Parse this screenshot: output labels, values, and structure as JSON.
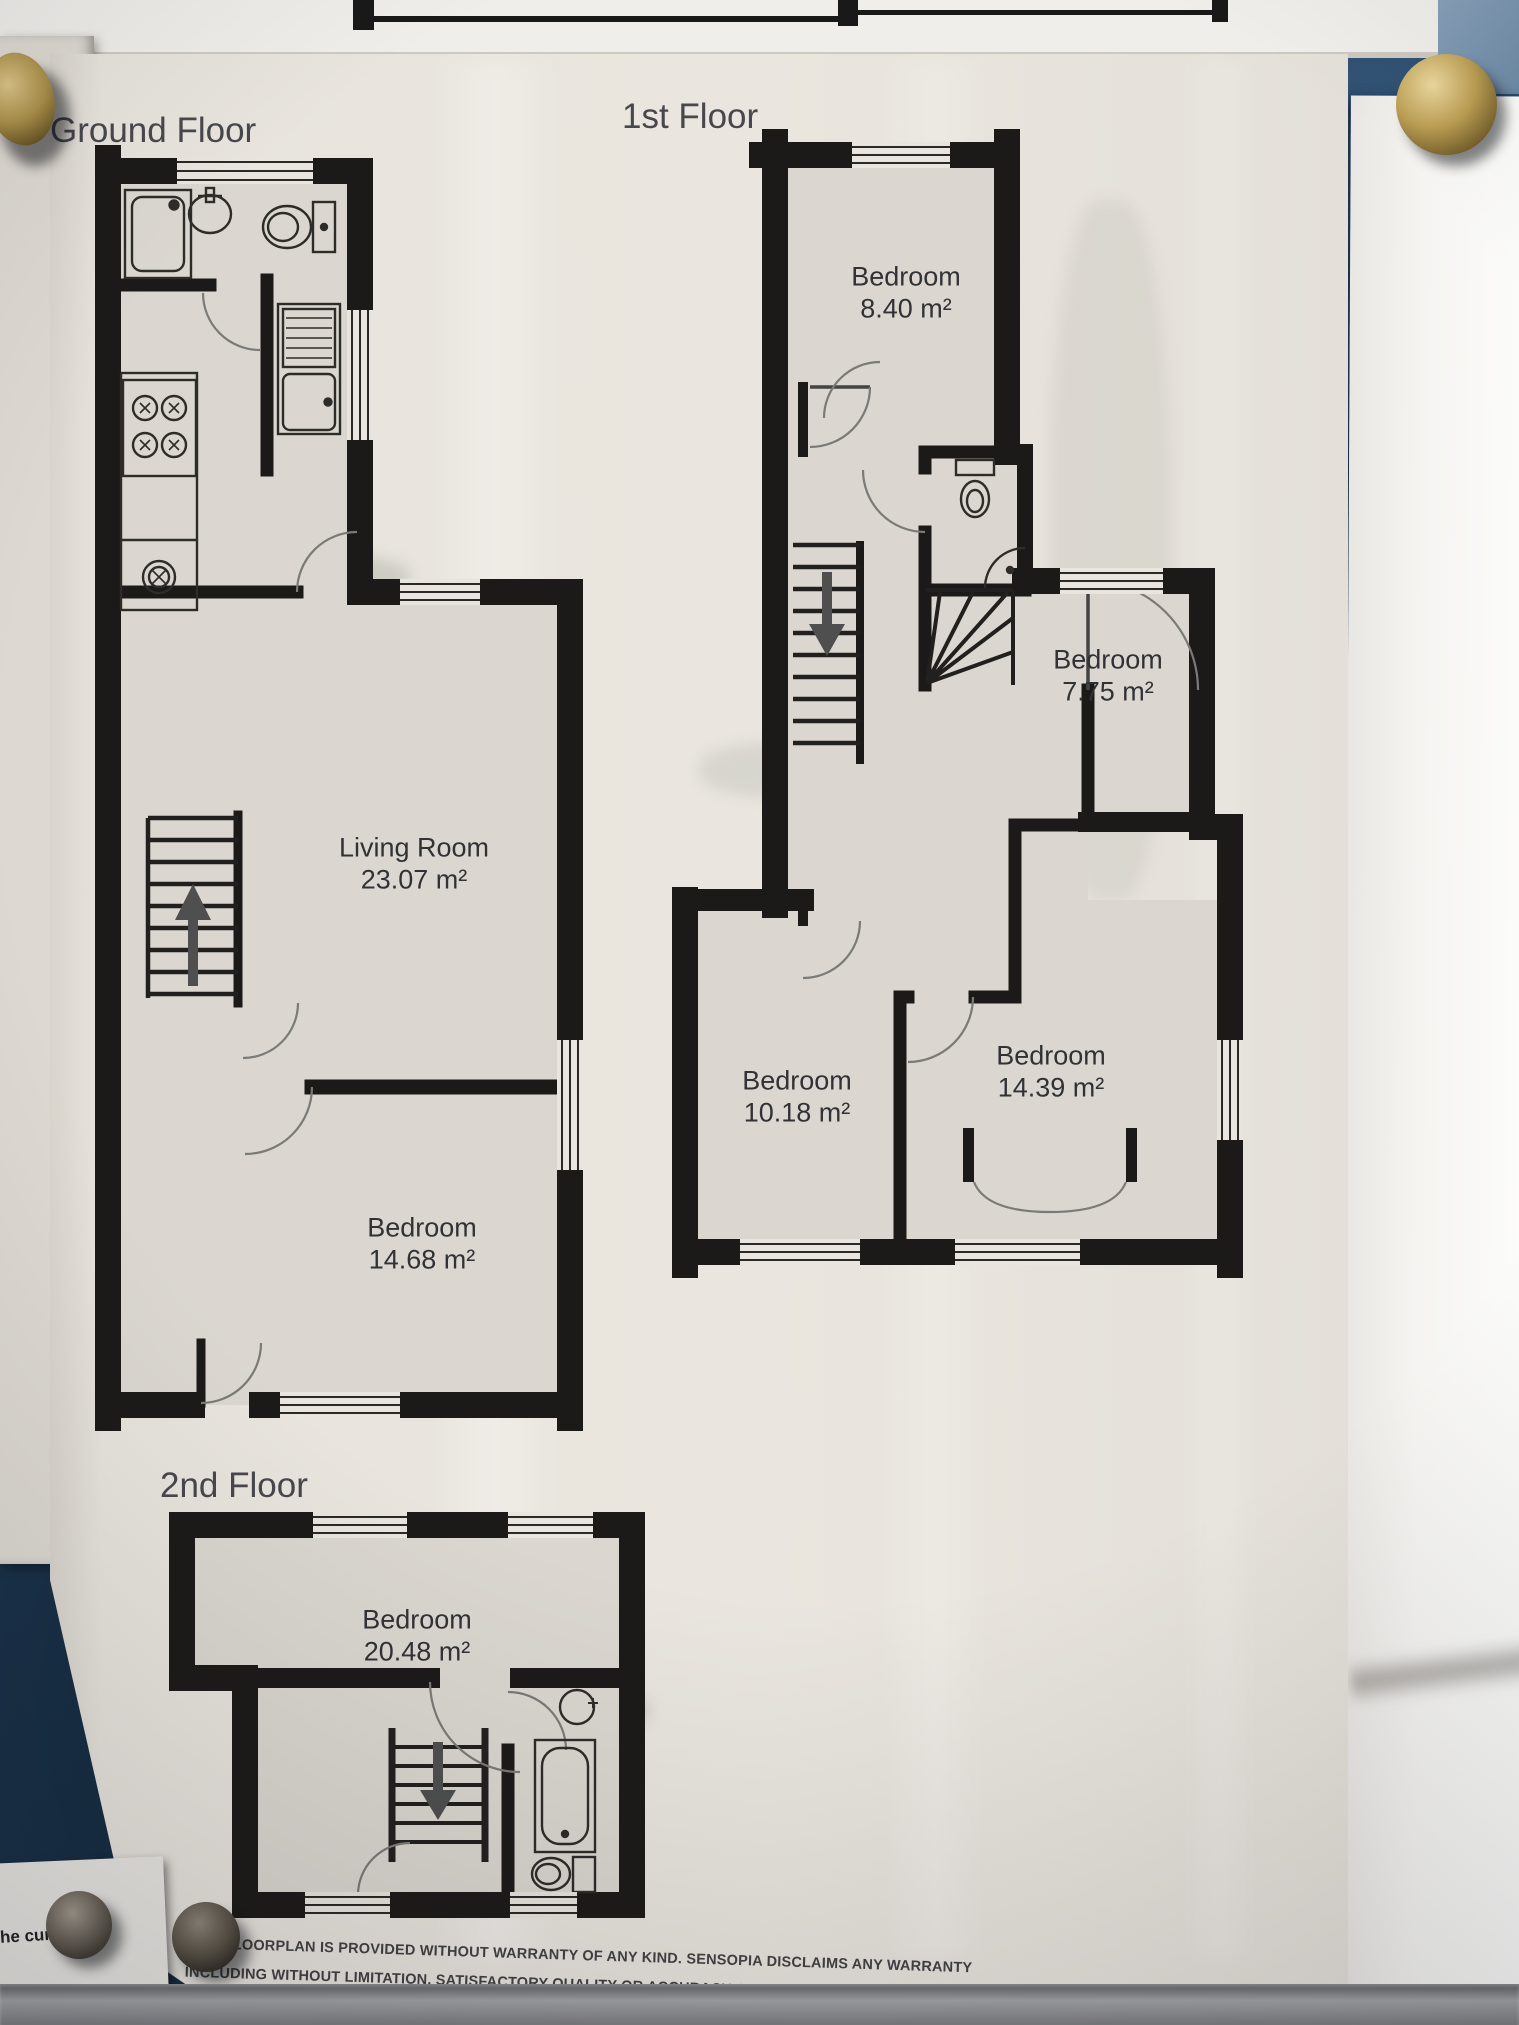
{
  "floorplan": {
    "floors": [
      {
        "id": "ground",
        "title": "Ground Floor",
        "rooms": [
          {
            "name": "Living Room",
            "area": "23.07 m²"
          },
          {
            "name": "Bedroom",
            "area": "14.68 m²"
          }
        ]
      },
      {
        "id": "first",
        "title": "1st Floor",
        "rooms": [
          {
            "name": "Bedroom",
            "area": "8.40 m²"
          },
          {
            "name": "Bedroom",
            "area": "7.75 m²"
          },
          {
            "name": "Bedroom",
            "area": "10.18 m²"
          },
          {
            "name": "Bedroom",
            "area": "14.39 m²"
          }
        ]
      },
      {
        "id": "second",
        "title": "2nd Floor",
        "rooms": [
          {
            "name": "Bedroom",
            "area": "20.48 m²"
          }
        ]
      }
    ],
    "disclaimer": {
      "line1": "THIS FLOORPLAN IS PROVIDED WITHOUT WARRANTY OF ANY KIND. SENSOPIA DISCLAIMS ANY WARRANTY",
      "line2": "INCLUDING WITHOUT LIMITATION, SATISFACTORY QUALITY OR ACCURACY OF DIMENSIONS"
    }
  },
  "background_note": {
    "text": "the curre"
  },
  "colors": {
    "wall": "#1c1a18",
    "paper": "#e9e5de",
    "room_fill": "#dbd7d0",
    "board_blue": "#234465",
    "brass_pin": "#c2a55c",
    "shelf_grey": "#8e9093"
  }
}
